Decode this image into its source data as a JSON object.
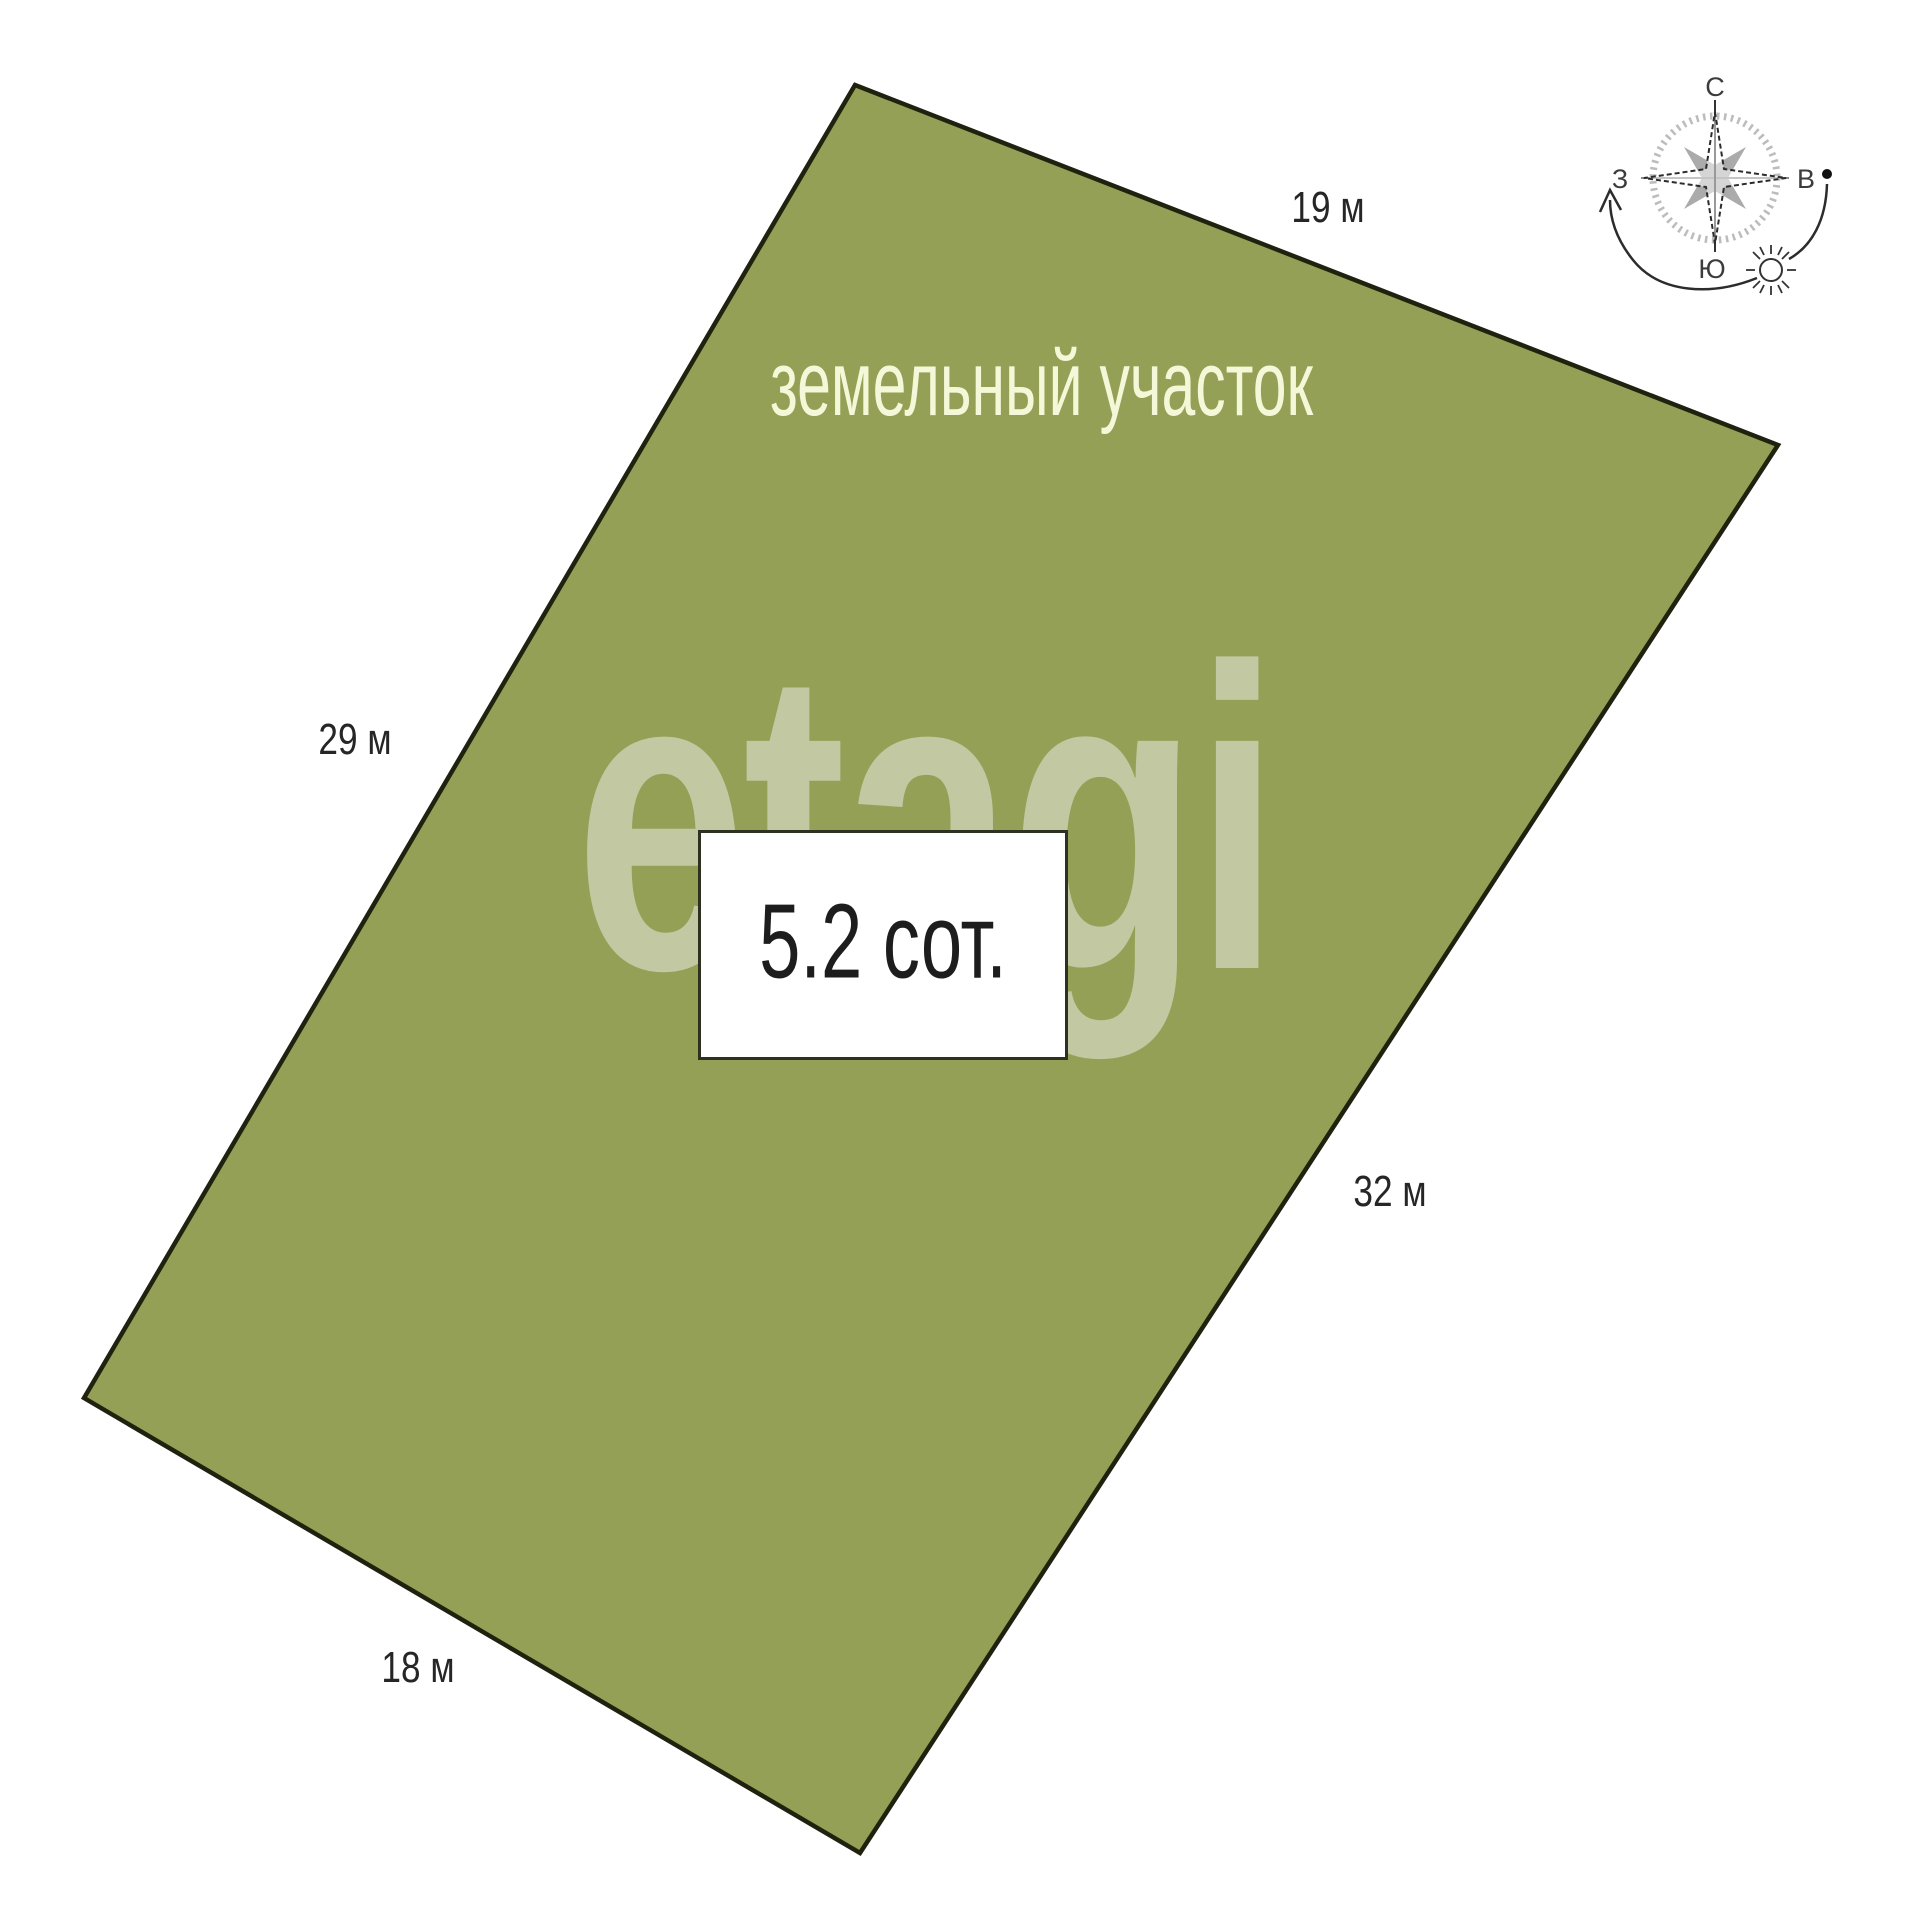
{
  "diagram": {
    "plot_label": "земельный участок",
    "area": "5.2 сот.",
    "side_lengths": {
      "top": "19 м",
      "left": "29 м",
      "right": "32 м",
      "bottom": "18 м"
    },
    "colors": {
      "plot_fill": "#94a055",
      "plot_border": "#20220f",
      "plot_label_text": "#f5f8d8",
      "dimension_text": "#262626"
    }
  },
  "compass": {
    "north": "С",
    "south": "Ю",
    "east": "В",
    "west": "З"
  },
  "watermark": "etagi"
}
